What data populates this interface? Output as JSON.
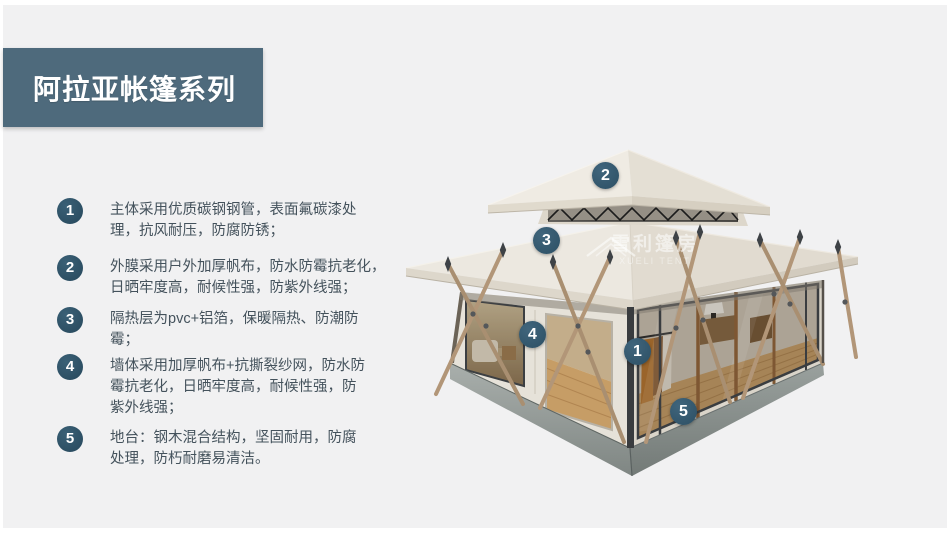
{
  "banner": {
    "title": "阿拉亚帐篷系列"
  },
  "features": [
    {
      "num": "1",
      "text": "主体采用优质碳钢钢管，表面氟碳漆处\n理，抗风耐压，防腐防锈；"
    },
    {
      "num": "2",
      "text": "外膜采用户外加厚帆布，防水防霉抗老化，\n日晒牢度高，耐候性强，防紫外线强；"
    },
    {
      "num": "3",
      "text": "隔热层为pvc+铝箔，保暖隔热、防潮防\n霉；"
    },
    {
      "num": "4",
      "text": "墙体采用加厚帆布+抗撕裂纱网，防水防\n霉抗老化，日晒牢度高，耐候性强，防\n紫外线强；"
    },
    {
      "num": "5",
      "text": "地台：钢木混合结构，坚固耐用，防腐\n处理，防朽耐磨易清洁。"
    }
  ],
  "tent": {
    "callouts": [
      {
        "num": "2",
        "target": "upper-roof-canopy"
      },
      {
        "num": "3",
        "target": "main-roof-membrane"
      },
      {
        "num": "4",
        "target": "wall-canvas-panel"
      },
      {
        "num": "1",
        "target": "steel-frame-post"
      },
      {
        "num": "5",
        "target": "base-platform"
      }
    ],
    "watermark": {
      "name": "雪利篷房",
      "name_en": "XUELI TENT"
    }
  },
  "colors": {
    "page_bg": "#f1f1f2",
    "frame": "#ffffff",
    "banner_bg": "#4e6a7c",
    "badge_bg": "#2b4f63",
    "callout_bg": "#35596d",
    "text": "#44525c",
    "roof_canvas": "#eae6de",
    "base_concrete": "#8b9290",
    "pole_wood": "#b29678"
  }
}
